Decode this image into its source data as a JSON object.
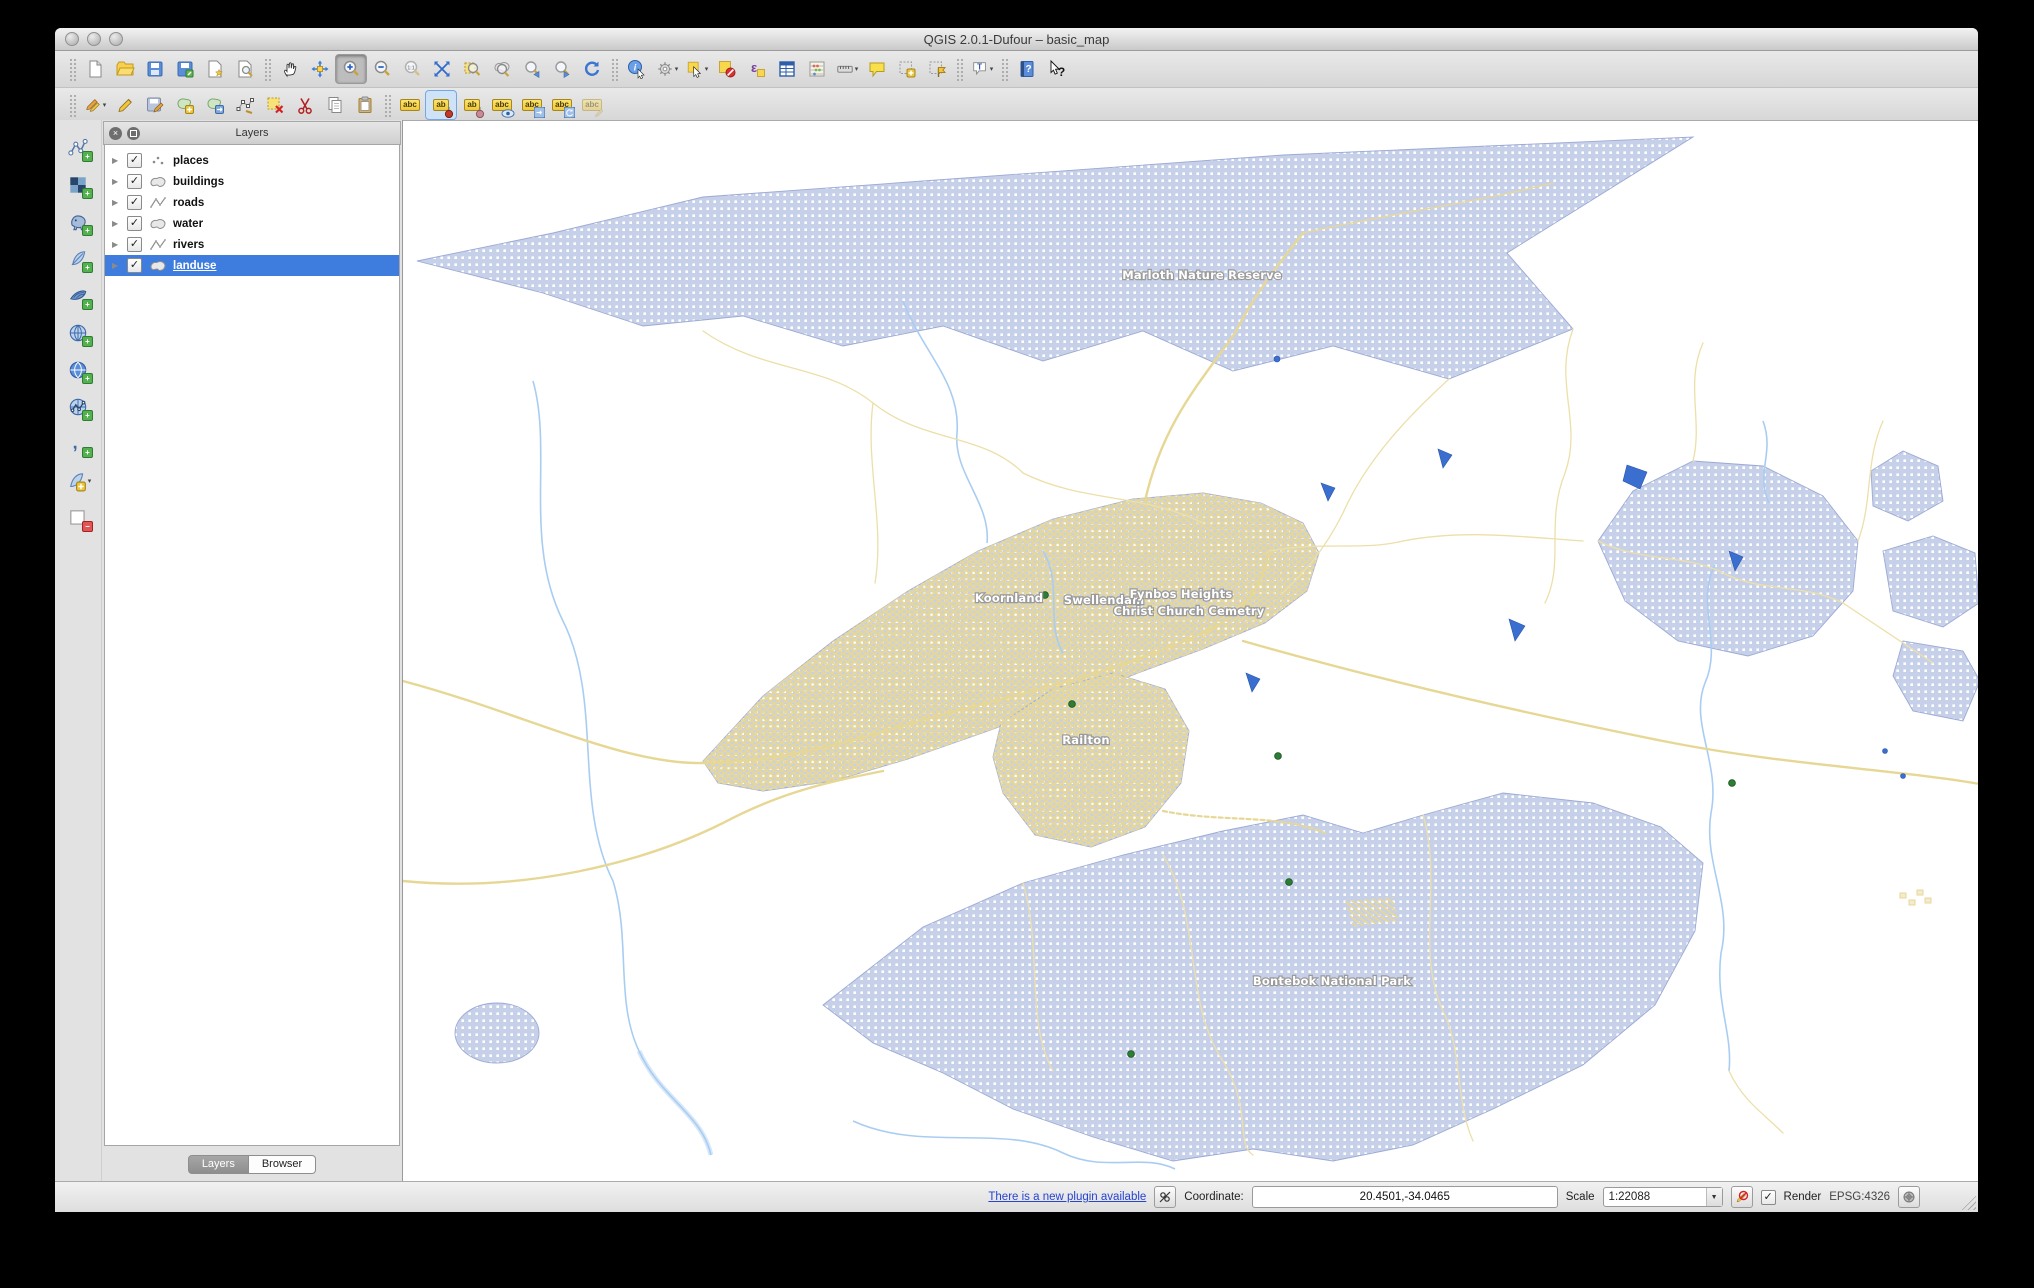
{
  "window": {
    "title": "QGIS 2.0.1-Dufour – basic_map"
  },
  "toolbars": {
    "file": [
      "new-project",
      "open-project",
      "save-project",
      "save-project-as",
      "new-composer",
      "composer-manager"
    ],
    "navigation": [
      "pan-map",
      "pan-to-selection",
      "zoom-in",
      "zoom-out",
      "zoom-native",
      "zoom-full",
      "zoom-to-selection",
      "zoom-to-layer",
      "zoom-last",
      "zoom-next",
      "refresh-map"
    ],
    "attributes": [
      "identify",
      "run-feature-action",
      "select-features",
      "deselect-features",
      "select-by-expression",
      "open-attribute-table",
      "field-calculator",
      "measure-line",
      "map-tips",
      "new-bookmark",
      "show-bookmarks",
      "text-annotation",
      "help-contents",
      "whats-this"
    ],
    "digitizing": [
      "current-edits",
      "toggle-editing",
      "save-layer-edits",
      "add-feature",
      "move-feature",
      "node-tool",
      "delete-selected",
      "cut-features",
      "copy-features",
      "paste-features"
    ],
    "labeling": [
      "labeling-options",
      "pin-unpin-labels",
      "highlight-pinned-labels",
      "show-hide-labels",
      "move-label",
      "rotate-label",
      "change-label"
    ],
    "active_tool": "zoom-in",
    "active_label_tool": "pin-unpin-labels",
    "tag_full": "abc",
    "tag_short": "ab"
  },
  "manage_layers_toolbar": [
    "add-vector-layer",
    "add-raster-layer",
    "add-postgis-layer",
    "add-spatialite-layer",
    "add-mssql-layer",
    "add-wms-layer",
    "add-wcs-layer",
    "add-wfs-layer",
    "add-delimited-text-layer",
    "new-shapefile-layer",
    "remove-layer"
  ],
  "layers_panel": {
    "title": "Layers",
    "layers": [
      {
        "name": "places",
        "type": "point",
        "checked": true,
        "selected": false
      },
      {
        "name": "buildings",
        "type": "polygon",
        "checked": true,
        "selected": false
      },
      {
        "name": "roads",
        "type": "line",
        "checked": true,
        "selected": false
      },
      {
        "name": "water",
        "type": "polygon",
        "checked": true,
        "selected": false
      },
      {
        "name": "rivers",
        "type": "line",
        "checked": true,
        "selected": false
      },
      {
        "name": "landuse",
        "type": "polygon",
        "checked": true,
        "selected": true
      }
    ],
    "tabs": [
      {
        "label": "Layers",
        "active": true
      },
      {
        "label": "Browser",
        "active": false
      }
    ]
  },
  "statusbar": {
    "plugin_link": "There is a new plugin available",
    "coordinate_label": "Coordinate:",
    "coordinate_value": "20.4501,-34.0465",
    "scale_label": "Scale",
    "scale_value": "1:22088",
    "render_label": "Render",
    "render_checked": true,
    "crs": "EPSG:4326"
  },
  "map": {
    "labels": [
      {
        "text": "Marloth Nature Reserve",
        "x": 799,
        "y": 158
      },
      {
        "text": "Koornland",
        "x": 606,
        "y": 481
      },
      {
        "text": "Swellendam",
        "x": 701,
        "y": 483
      },
      {
        "text": "Fynbos Heights",
        "x": 778,
        "y": 477
      },
      {
        "text": "Christ Church Cemetry",
        "x": 786,
        "y": 494
      },
      {
        "text": "Railton",
        "x": 683,
        "y": 623
      },
      {
        "text": "Bontebok National Park",
        "x": 929,
        "y": 864
      }
    ],
    "places": [
      {
        "x": 642,
        "y": 474
      },
      {
        "x": 669,
        "y": 583
      },
      {
        "x": 875,
        "y": 635
      },
      {
        "x": 886,
        "y": 761
      },
      {
        "x": 728,
        "y": 933
      },
      {
        "x": 1329,
        "y": 662
      }
    ],
    "colors": {
      "landuse_fill": "#c7d0e9",
      "landuse_dot": "#ffffff",
      "landuse_stroke": "#93a3d1",
      "road": "#e7d795",
      "road_light": "#ecdfa8",
      "river": "#a9cdf2",
      "water": "#3a6fd0",
      "place_dot": "#2d7d35"
    }
  }
}
